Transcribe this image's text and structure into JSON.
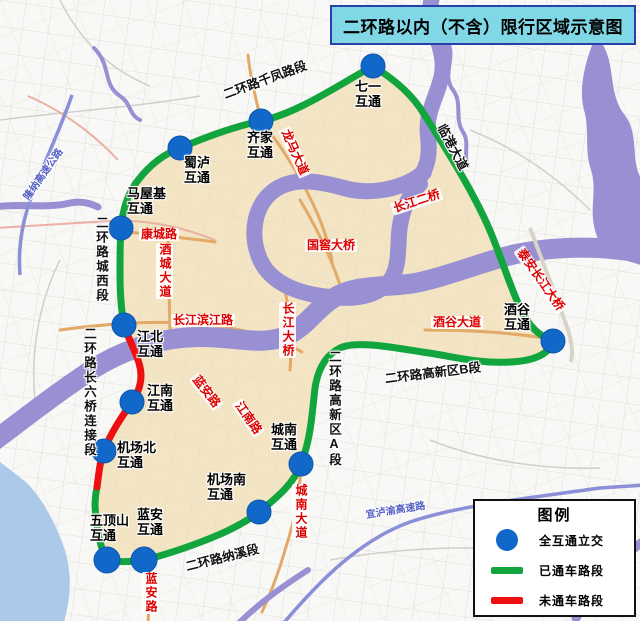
{
  "title": "二环路以内（不含）限行区域示意图",
  "legend": {
    "title": "图例",
    "items": [
      {
        "symbol": "interchange-dot",
        "label": "全互通立交"
      },
      {
        "symbol": "open-road-line",
        "label": "已通车路段"
      },
      {
        "symbol": "closed-road-line",
        "label": "未通车路段"
      }
    ]
  },
  "interchanges": {
    "qiyi": "七一\n互通",
    "qijia": "齐家\n互通",
    "shulu": "蜀泸\n互通",
    "mawuji": "马屋基\n互通",
    "jiangbei": "江北\n互通",
    "jiangnan": "江南\n互通",
    "jichangbei": "机场北\n互通",
    "jichangnan": "机场南\n互通",
    "wudingshan": "五顶山\n互通",
    "lanan": "蓝安\n互通",
    "chengnan": "城南\n互通",
    "jiugu": "酒谷\n互通"
  },
  "sections": {
    "qianfeng": "二环路千凤路段",
    "chengxi": "二环路城西段",
    "liuqiao": "二环路长六桥连接段",
    "naxi": "二环路纳溪段",
    "gaoxinA": "二环路高新区A段",
    "gaoxinB": "二环路高新区B段",
    "lingang": "临港大道"
  },
  "roads": {
    "longma": "龙马大道",
    "kangcheng": "康城路",
    "jiucheng": "酒城大道",
    "binjiang": "长江滨江路",
    "changjiang2qiao": "长江二桥",
    "guojiao": "国窖大桥",
    "changjiangdaqiao": "长江大桥",
    "jiugudadao": "酒谷大道",
    "taian": "泰安长江大桥",
    "lananlu": "蓝安路",
    "jiangnanlu": "江南路",
    "chengnandadao": "城南大道"
  },
  "highways": {
    "longna": "隆纳高速公路",
    "yiluyu": "宜泸渝高速路"
  },
  "colors": {
    "ring_open": "#13a53d",
    "ring_closed": "#ee1010",
    "interchange_dot": "#1168c9",
    "river": "#9890d2",
    "urban_area": "#f2e3c0",
    "title_bg": "#80d7e6",
    "title_border": "#2b3fa8",
    "road_label_red": "#dd0000",
    "highway_label_blue": "#5560c4"
  }
}
